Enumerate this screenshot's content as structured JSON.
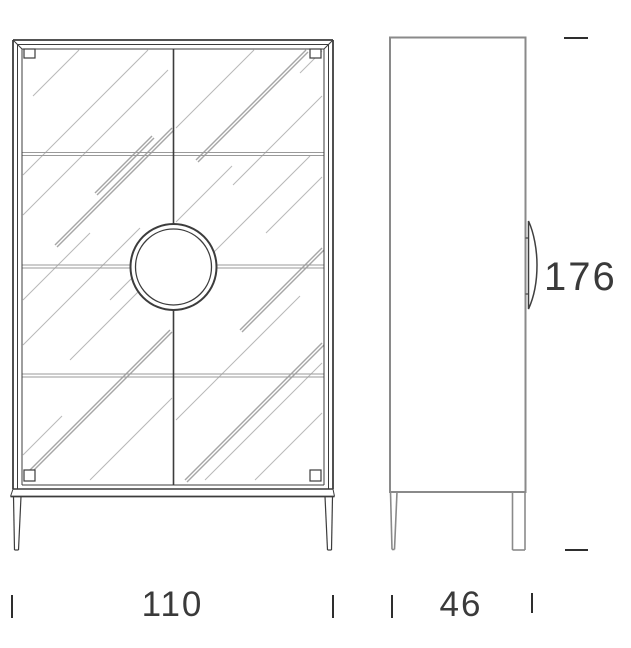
{
  "drawing": {
    "kind": "furniture-technical-drawing",
    "dimensions": {
      "width": {
        "label": "110"
      },
      "depth": {
        "label": "46"
      },
      "height": {
        "label": "176"
      }
    },
    "colors": {
      "front_outline": "#3c3c3c",
      "side_outline": "#8a8a8a",
      "glass_reflection": "#b8b8b8",
      "glass_reflection_accent": "#a6a6a6",
      "shelf_line": "#9a9a9a",
      "dimension_text": "#3a3a3a",
      "dimension_tick": "#2e2e2e",
      "background": "#ffffff"
    }
  }
}
